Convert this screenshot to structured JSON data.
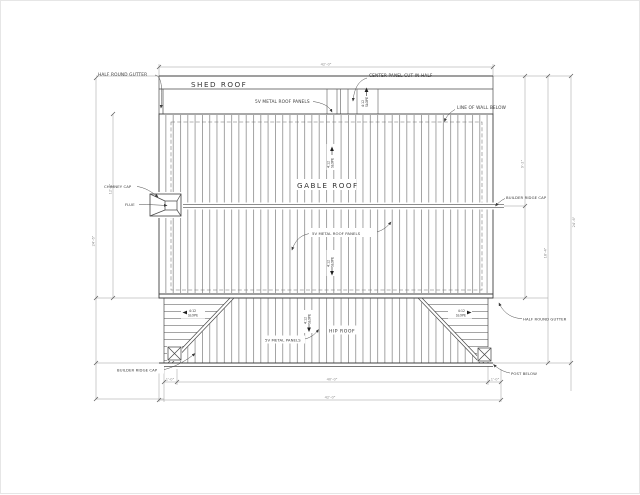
{
  "labels": {
    "half_round_gutter_left": "HALF ROUND GUTTER",
    "shed_roof": "SHED ROOF",
    "sv_panels_shed": "5V METAL ROOF PANELS",
    "center_panel": "CENTER PANEL CUT IN HALF",
    "line_of_wall": "LINE OF WALL BELOW",
    "chimney_cap": "CHIMNEY CAP",
    "flue": "FLUE",
    "gable_roof": "GABLE ROOF",
    "sv_panels_gable": "5V METAL ROOF PANELS",
    "builder_ridge_cap_right": "BUILDER RIDGE CAP",
    "half_round_gutter_right": "HALF ROUND GUTTER",
    "hip_roof": "HIP ROOF",
    "sv_panels_hip": "5V METAL PANELS",
    "builder_ridge_cap_left": "BUILDER RIDGE CAP",
    "post_below": "POST BELOW"
  },
  "slope": {
    "ratio": "4:12",
    "word": "SLOPE"
  },
  "dims": {
    "top_width": "42'-0\"",
    "bottom_inner": "40'-0\"",
    "bottom_overall": "42'-0\"",
    "bottom_left_offset": "1'-0\"",
    "bottom_right_offset": "1'-0\"",
    "left_overall": "24'-6\"",
    "left_upper": "12'-2\"",
    "right_upper": "9'-2\"",
    "right_mid": "18'-4\"",
    "right_overall": "24'-6\""
  },
  "colors": {
    "line": "#3f3f3f",
    "panel": "#5a5a5a",
    "dim": "#9c9c9c",
    "background": "#ffffff"
  }
}
